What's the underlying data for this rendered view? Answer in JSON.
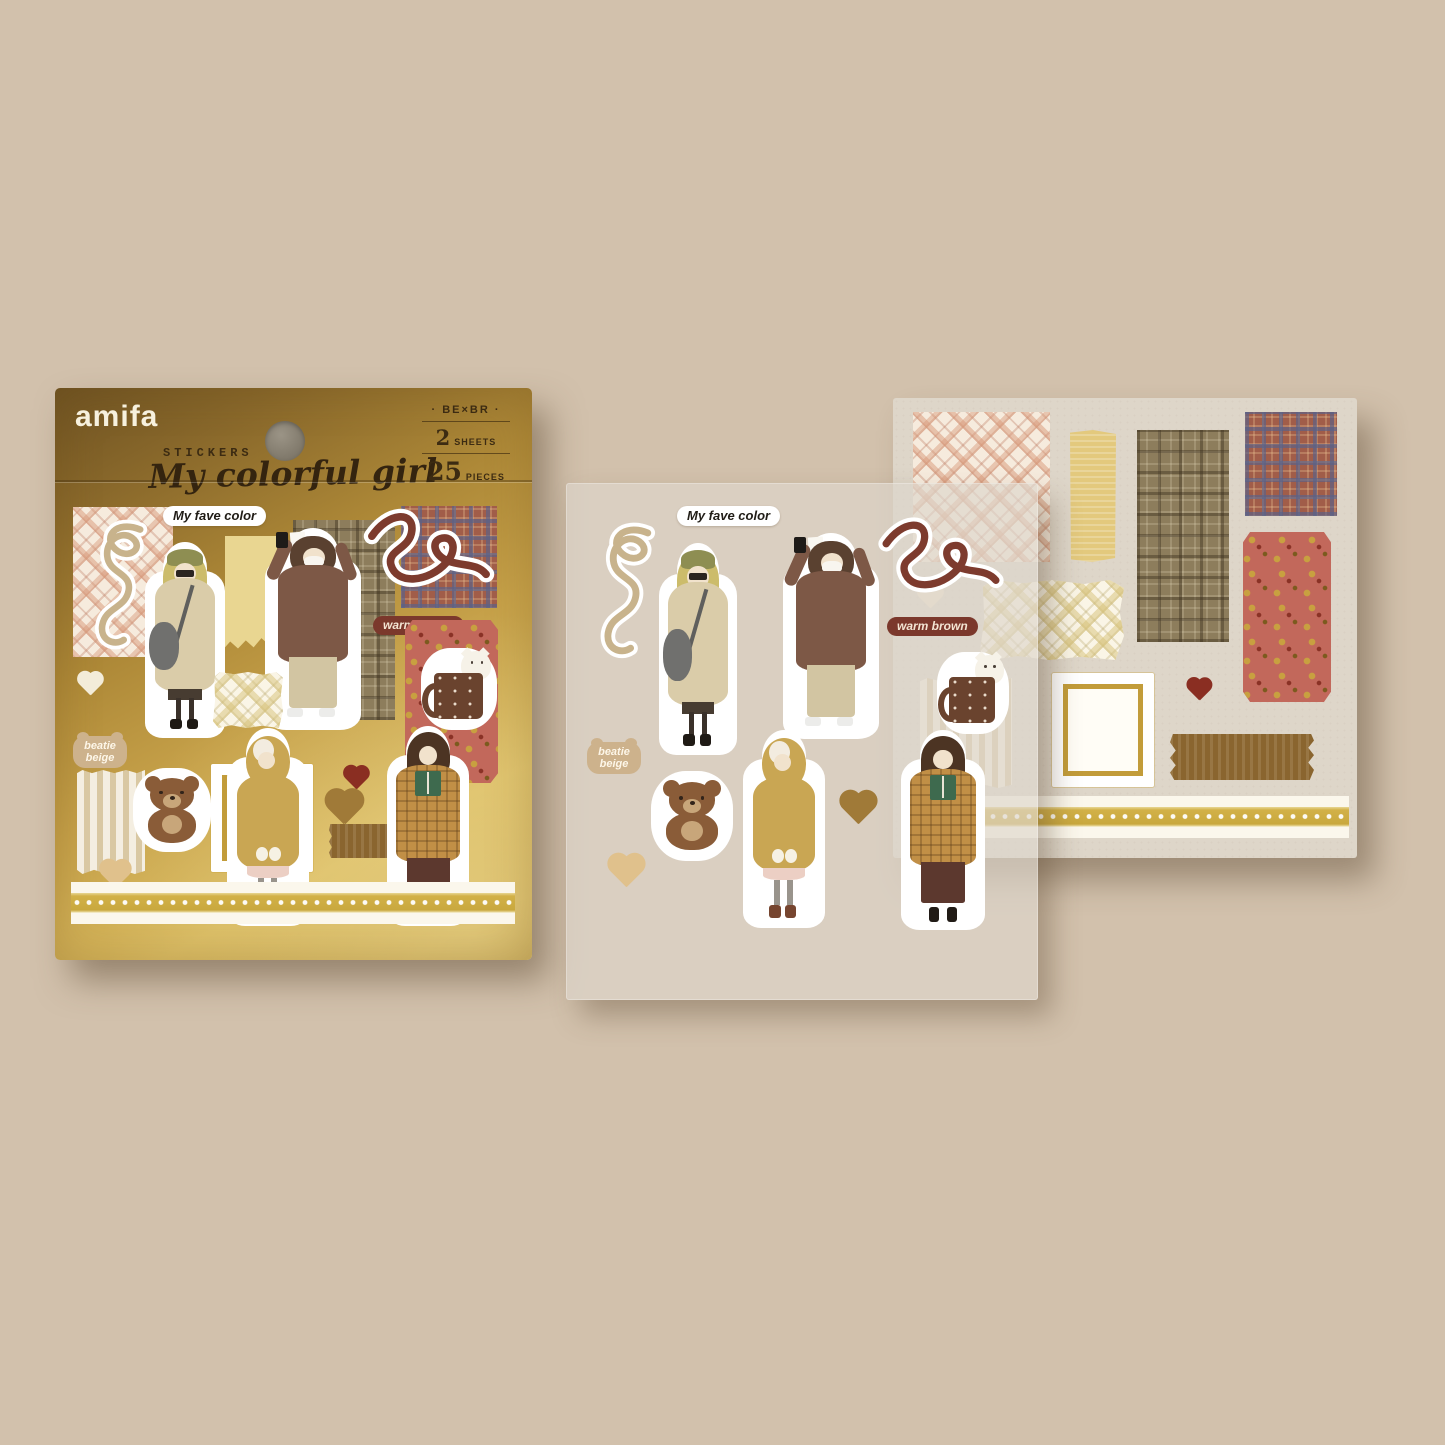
{
  "scene": {
    "background_color": "#d2c1ac",
    "description": "amifa flake sticker pack with two sticker sheets beside it"
  },
  "package": {
    "brand": "amifa",
    "product_type": "STICKERS",
    "title": "My colorful girl",
    "color_code": "· BE×BR ·",
    "sheets_count": "2",
    "sheets_label": "SHEETS",
    "pieces_count": "25",
    "pieces_label": "PIECES",
    "colors": {
      "foil_dark": "#6e5222",
      "foil_light": "#d9ba5f"
    }
  },
  "sticker_labels": {
    "fave_color": "My fave color",
    "warm_brown": "warm brown",
    "beatie_beige": "beatie beige"
  },
  "sheet_front": {
    "pieces": [
      "fave-color label",
      "tan ribbon",
      "girl in beige duffle coat",
      "girl in brown coat taking photo",
      "maroon ribbon",
      "warm-brown label",
      "cocoa mug with cat",
      "beatie-beige label",
      "teddy bear",
      "girl in mustard hood",
      "brown heart",
      "cream heart",
      "girl reading green book"
    ]
  },
  "sheet_back": {
    "pieces": [
      "pink plaid paper",
      "yellow tape",
      "brown tartan paper",
      "red-blue plaid paper",
      "red floral paper",
      "diamond plaid paper",
      "cream heart",
      "striped paper",
      "gold frame",
      "dark red heart",
      "brown washi tape",
      "lace ribbon trim"
    ]
  }
}
